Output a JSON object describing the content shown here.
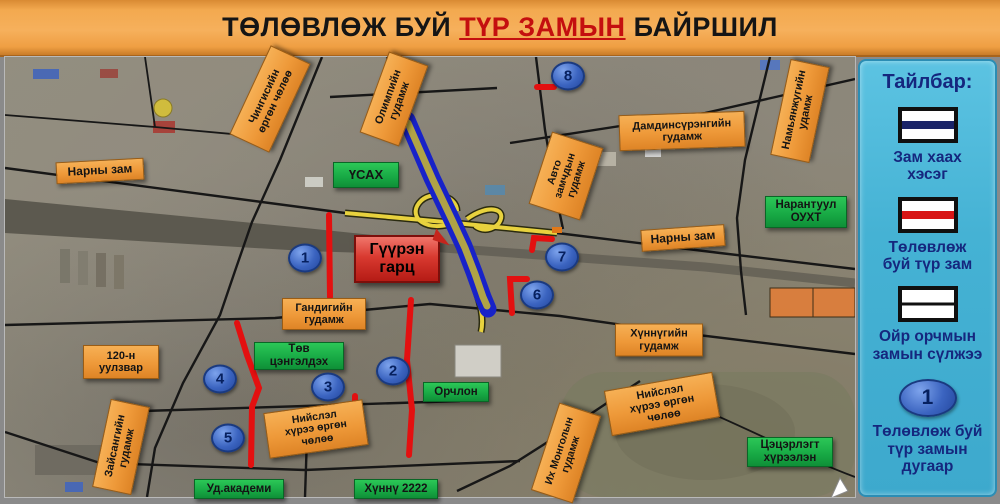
{
  "title": {
    "prefix": "ТӨЛӨВЛӨЖ БУЙ ",
    "highlight": "ТҮР ЗАМЫН",
    "suffix": " БАЙРШИЛ"
  },
  "legend": {
    "title": "Тайлбар:",
    "items": [
      {
        "symbol": "road-closed-swatch",
        "label": "Зам хаах\nхэсэг"
      },
      {
        "symbol": "planned-temp-road-swatch",
        "label": "Төлөвлөж\nбуй түр зам"
      },
      {
        "symbol": "nearby-road-network-swatch",
        "label": "Ойр орчмын\nзамын сүлжээ"
      },
      {
        "symbol": "number-marker",
        "marker_number": "1",
        "label": "Төлөвлөж буй\nтүр замын\nдугаар"
      }
    ]
  },
  "map": {
    "callout": {
      "text": "Гүүрэн\nгарц"
    },
    "road_labels": [
      {
        "text": "Нарны зам"
      },
      {
        "text": "Чингисийн\nөргөн чөлөө"
      },
      {
        "text": "Олимпийн\nгудамж"
      },
      {
        "text": "Дамдинсүрэнгийн\nгудамж"
      },
      {
        "text": "Намьянжугийн\nудамж"
      },
      {
        "text": "Авто\nзамчдын\nгудамж"
      },
      {
        "text": "Нарны зам"
      },
      {
        "text": "120-н\nуулзвар"
      },
      {
        "text": "Зайсангийн\nгудамж"
      },
      {
        "text": "Гандигийн\nгудамж"
      },
      {
        "text": "Нийслэл\nхүрээ өргөн\nчөлөө"
      },
      {
        "text": "Хүннүгийн\nгудамж"
      },
      {
        "text": "Нийслэл\nхүрээ өргөн\nчөлөө"
      },
      {
        "text": "Их Монголын\nгудамж"
      }
    ],
    "place_labels": [
      {
        "text": "ҮСАХ"
      },
      {
        "text": "Нарантуул\nОУХТ"
      },
      {
        "text": "Төв\nцэнгэлдэх"
      },
      {
        "text": "Орчлон"
      },
      {
        "text": "Уд.академи"
      },
      {
        "text": "Хүннү 2222"
      },
      {
        "text": "Цэцэрлэгт\nхүрээлэн"
      }
    ],
    "markers": [
      {
        "n": "1"
      },
      {
        "n": "2"
      },
      {
        "n": "3"
      },
      {
        "n": "4"
      },
      {
        "n": "5"
      },
      {
        "n": "6"
      },
      {
        "n": "7"
      },
      {
        "n": "8"
      }
    ],
    "colors": {
      "title_bar": "#f3a94f",
      "title_highlight": "#c40f0f",
      "road_label_orange": "#ee9939",
      "place_label_green": "#17a844",
      "callout_red": "#d93a30",
      "planned_road_red": "#e31010",
      "closed_road_blue": "#1822c8",
      "ramp_yellow": "#e8d23e",
      "marker_blue": "#3b64c0",
      "legend_panel_blue": "#45b2d4",
      "legend_text_navy": "#15277e"
    }
  }
}
